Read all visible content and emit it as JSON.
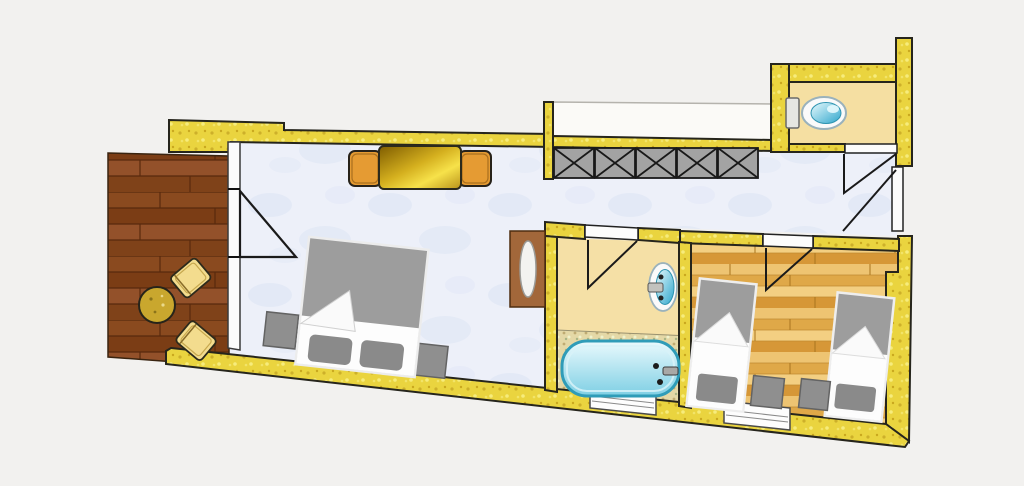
{
  "title": "apartment-floor-plan",
  "colors": {
    "canvas_bg": "#f2f1ef",
    "wall_fill": "#ead43f",
    "wall_outline": "#26251c",
    "balcony_wood": "#8a4a1f",
    "main_floor": "#edf0f9",
    "floor_mottle": "#dbe3f3",
    "parquet_base": "#eec472",
    "bath_floor": "#f5e0a6",
    "wc_floor": "#f5dfa2",
    "niche_fill": "#fbfaf7",
    "wardrobe_fill": "#a3a3a3",
    "bed_gray": "#9d9d9d",
    "pillow_gray": "#8a8a8a",
    "nightstand_gray": "#8f8f8f",
    "linen_white": "#fdfdfd",
    "tub_blue": "#8ed9ea",
    "tub_outline": "#2f9cb8",
    "water_blue": "#3fb4d4",
    "fixture_white": "#fafafa",
    "fixture_rim": "#9ab2bc",
    "table_gold": "#d4af1e",
    "chair_orange": "#e59b33",
    "balcony_chair": "#f3dc8e",
    "balcony_table": "#c9a72e",
    "cabinet_brown": "#a2673a",
    "window_white": "#fdfdfd",
    "deck_speckle": "#e4d8a6",
    "door_line": "#1a1a1a"
  },
  "elements": {
    "rooms": [
      "balcony-terrace",
      "main-room",
      "corridor",
      "bathroom",
      "wc-room",
      "twin-bedroom",
      "niche"
    ],
    "furniture": [
      "double-bed",
      "single-bed",
      "single-bed",
      "nightstand",
      "nightstand",
      "nightstand",
      "nightstand",
      "dining-table",
      "dining-chair",
      "dining-chair",
      "balcony-table",
      "balcony-chair",
      "balcony-chair",
      "wardrobe",
      "cabinet"
    ],
    "fixtures": [
      "toilet",
      "sink",
      "bathtub"
    ],
    "openings": [
      "balcony-door",
      "bathroom-door",
      "bedroom-door",
      "wc-door",
      "entrance-door",
      "window",
      "window"
    ],
    "wardrobe_sections": 5
  }
}
